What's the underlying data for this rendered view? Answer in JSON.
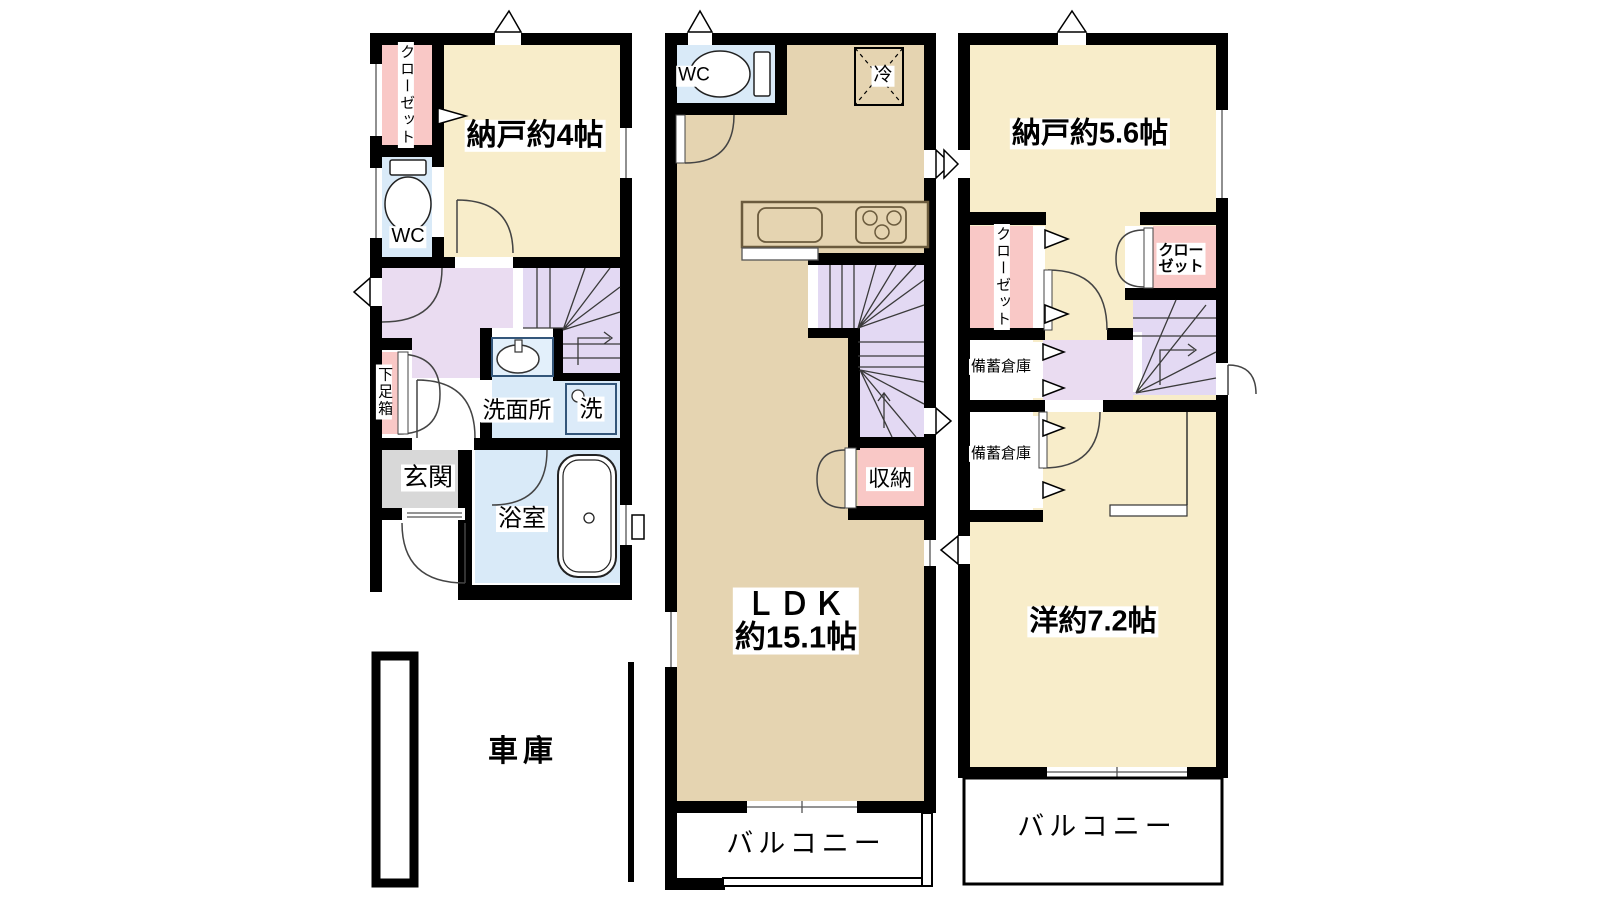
{
  "plan": {
    "floor1": {
      "closet": "クローゼット",
      "storage_room": "納戸約4帖",
      "toilet": "WC",
      "shoe_cabinet": "下足箱",
      "washroom": "洗面所",
      "washer": "洗",
      "entrance": "玄関",
      "bathroom": "浴室",
      "garage": "車庫"
    },
    "floor2": {
      "toilet": "WC",
      "refrigerator": "冷",
      "ldk_name": "ＬＤＫ",
      "ldk_area": "約15.1帖",
      "storage": "収納",
      "balcony": "バルコニー"
    },
    "floor3": {
      "storage_room": "納戸約5.6帖",
      "closet_left": "クローゼット",
      "closet_right_line1": "クロー",
      "closet_right_line2": "ゼット",
      "stockpile_1": "備蓄倉庫",
      "stockpile_2": "備蓄倉庫",
      "western_room": "洋約7.2帖",
      "balcony": "バルコニー"
    }
  },
  "colors": {
    "wall": "#000000",
    "room_cream": "#F8EDCA",
    "room_tan": "#E5D4B1",
    "room_pink": "#F9C8C6",
    "room_blue": "#D9EAF8",
    "hall_purple": "#EADCF1",
    "stairs_purple": "#E3D9F3",
    "entrance_gray": "#D8D8D8"
  }
}
